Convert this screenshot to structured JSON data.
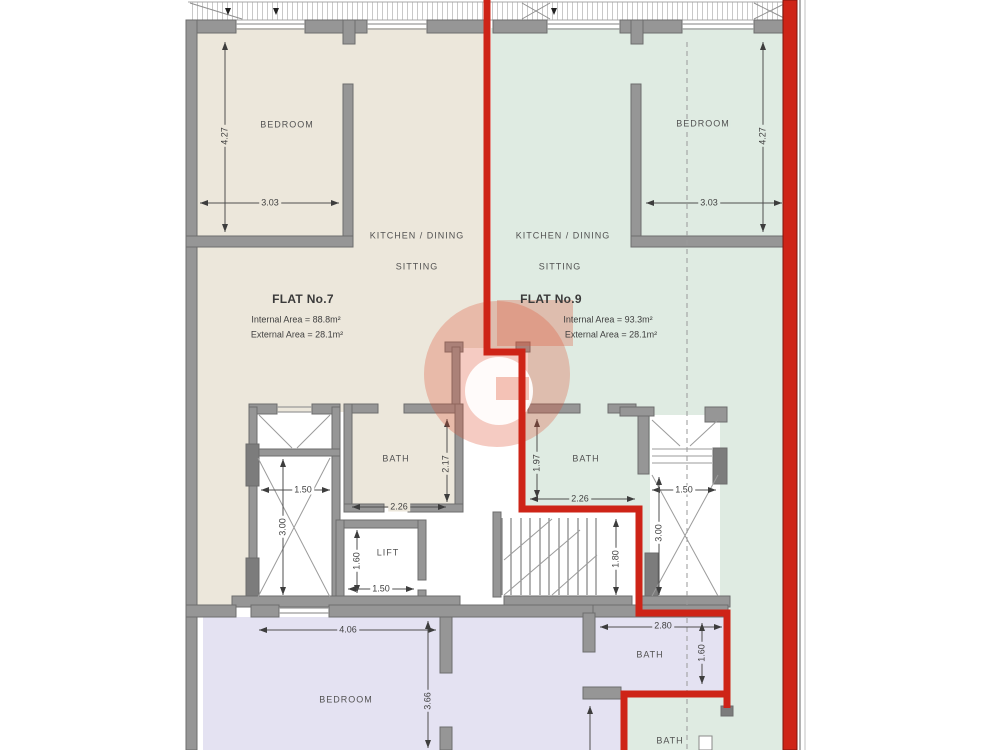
{
  "plan": {
    "flats": {
      "flat7": {
        "title": "FLAT No.7",
        "internal_area": "Internal Area = 88.8m²",
        "external_area": "External Area = 28.1m²"
      },
      "flat9": {
        "title": "FLAT No.9",
        "internal_area": "Internal Area = 93.3m²",
        "external_area": "External Area = 28.1m²"
      }
    },
    "rooms": {
      "bedroom7": "BEDROOM",
      "kitchen_dining7": "KITCHEN / DINING",
      "sitting7": "SITTING",
      "bath7": "BATH",
      "lift": "LIFT",
      "bedroom9": "BEDROOM",
      "kitchen_dining9": "KITCHEN / DINING",
      "sitting9": "SITTING",
      "bath9": "BATH",
      "bedroom_lower": "BEDROOM",
      "bath_lower": "BATH",
      "bath_lower_right": "BATH"
    },
    "dimensions": {
      "bed7_height": "4.27",
      "bed7_width": "3.03",
      "bed9_width": "3.03",
      "bed9_height": "4.27",
      "shaft_left_width": "1.50",
      "shaft_left_height": "3.00",
      "bath7_width": "2.26",
      "bath7_height": "2.17",
      "lift_height": "1.60",
      "lift_width": "1.50",
      "bath9_height": "1.97",
      "bath9_width": "2.26",
      "shaft_right_width": "1.50",
      "shaft_right_height": "3.00",
      "stairs_height": "1.80",
      "bedroom_lower_width": "4.06",
      "bedroom_lower_height": "3.66",
      "bath_lower_width": "2.80",
      "bath_lower_height": "1.60"
    },
    "colors": {
      "flat7_fill": "#ece7db",
      "flat9_fill": "#dfebe2",
      "flat_lower_fill": "#e4e2f2",
      "boundary_red": "#ce2417",
      "wall_gray": "#969696",
      "watermark_salmon": "#e45f3f"
    }
  }
}
